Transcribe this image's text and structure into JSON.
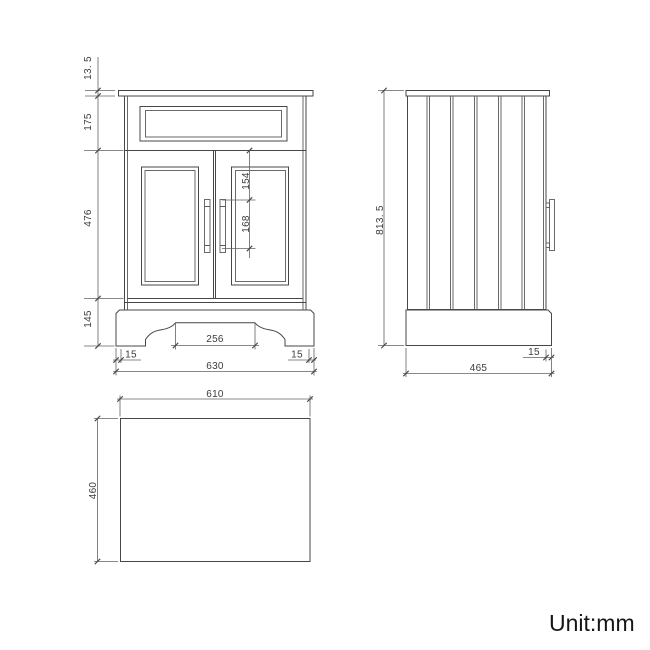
{
  "unit_label": "Unit:mm",
  "front": {
    "countertop_thickness": "13. 5",
    "drawer_section_height": "175",
    "door_section_height": "476",
    "plinth_height": "145",
    "handle_top_offset": "154",
    "handle_length": "168",
    "plinth_cutout_width": "256",
    "plinth_inset_left": "15",
    "plinth_inset_right": "15",
    "overall_width": "630"
  },
  "side": {
    "overall_height": "813. 5",
    "plinth_inset": "15",
    "overall_depth": "465"
  },
  "top": {
    "width": "610",
    "depth": "460"
  }
}
